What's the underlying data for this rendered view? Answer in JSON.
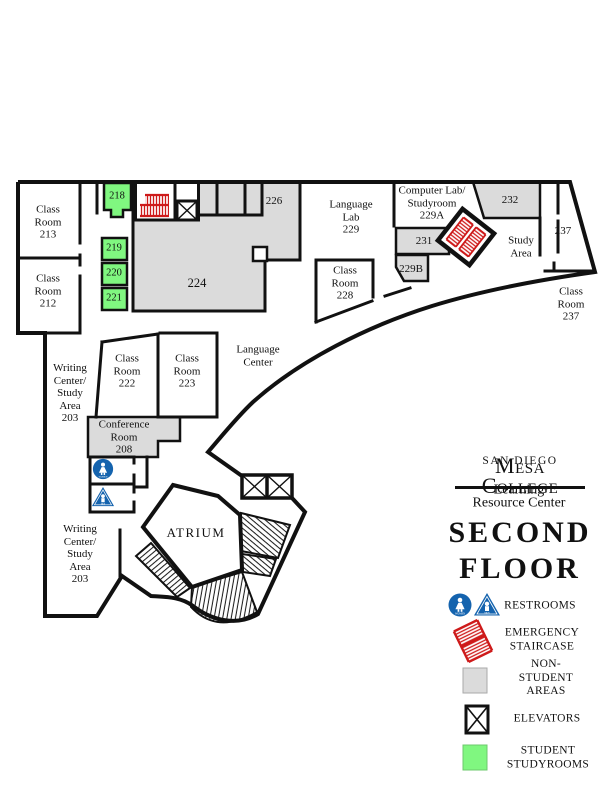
{
  "map": {
    "rooms": {
      "r213": "Class\nRoom\n213",
      "r212": "Class\nRoom\n212",
      "r218": "218",
      "r219": "219",
      "r220": "220",
      "r221": "221",
      "r224": "224",
      "r226": "226",
      "language_lab": "Language\nLab\n229",
      "computer_lab": "Computer Lab/\nStudyroom\n229A",
      "r231": "231",
      "r229b": "229B",
      "r232": "232",
      "study_area": "Study\nArea",
      "r237": "237",
      "classroom_237": "Class\nRoom\n237",
      "r228": "Class\nRoom\n228",
      "language_center": "Language\nCenter",
      "r222": "Class\nRoom\n222",
      "r223": "Class\nRoom\n223",
      "conference_208": "Conference\nRoom\n208",
      "writing_center_upper": "Writing\nCenter/\nStudy\nArea\n203",
      "writing_center_lower": "Writing\nCenter/\nStudy\nArea\n203",
      "atrium": "ATRIUM"
    },
    "icons": {
      "women_label": "WOMEN",
      "men_label": "MEN"
    }
  },
  "branding": {
    "school_small": "SAN DIEGO",
    "school_large": "Mesa College",
    "subtitle": "Learning Resource Center",
    "floor_line1": "SECOND",
    "floor_line2": "FLOOR"
  },
  "legend": {
    "restrooms": "RESTROOMS",
    "emergency": "EMERGENCY\nSTAIRCASE",
    "non_student": "NON-STUDENT\nAREAS",
    "elevators": "ELEVATORS",
    "student": "STUDENT\nSTUDYROOMS"
  },
  "colors": {
    "student_green": "#80F780",
    "non_student_gray": "#DBDBDB",
    "emergency_red": "#CE1A1A",
    "restroom_blue": "#1463AE",
    "wall_black": "#111111"
  }
}
